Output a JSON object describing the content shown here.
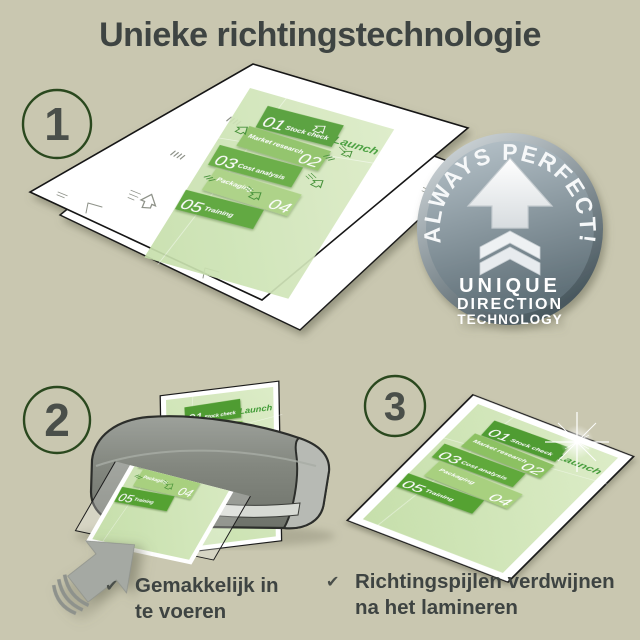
{
  "title": "Unieke richtingstechnologie",
  "step_numbers": [
    "1",
    "2",
    "3"
  ],
  "badge": {
    "arc_text": "ALWAYS PERFECT!",
    "line1": "UNIQUE",
    "line2": "DIRECTION",
    "line3": "TECHNOLOGY"
  },
  "document": {
    "launch": "Launch",
    "items": [
      {
        "num": "01",
        "label": "Stock check"
      },
      {
        "num": "02",
        "label": "Market research"
      },
      {
        "num": "03",
        "label": "Cost analysis"
      },
      {
        "num": "04",
        "label": "Packaging"
      },
      {
        "num": "05",
        "label": "Training"
      }
    ]
  },
  "captions": [
    {
      "icon": "✔",
      "line1": "Gemakkelijk in",
      "line2": "te voeren"
    },
    {
      "icon": "✔",
      "line1": "Richtingspijlen verdwijnen",
      "line2": "na het lamineren"
    }
  ],
  "colors": {
    "background": "#c9c7b0",
    "title_text": "#3e4442",
    "green_dark": "#4f9c31",
    "green_mid": "#61a93b",
    "green_light": "#8cc162",
    "green_pale": "#a8d07f",
    "doc_background": "#cfe4b6",
    "badge_gray": "#7b8c96",
    "machine_gray": "#82867f"
  }
}
